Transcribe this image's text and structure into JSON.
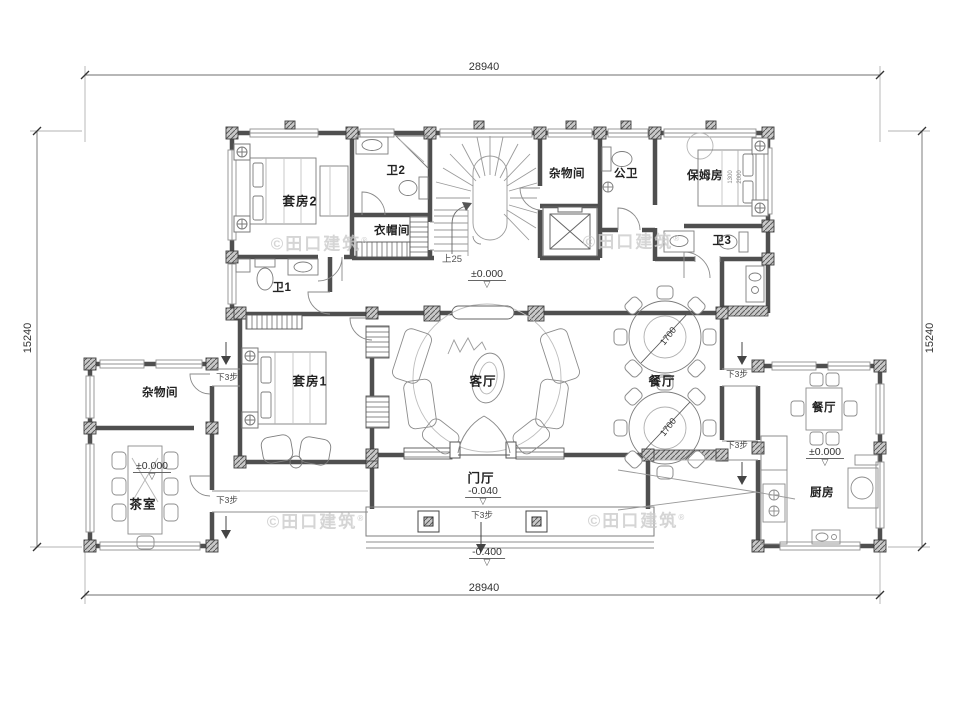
{
  "drawing": {
    "dims": {
      "width": "28940",
      "depth": "15240"
    },
    "rooms": {
      "suite2": "套房2",
      "bath2": "卫2",
      "cloakroom": "衣帽间",
      "storage_top": "杂物间",
      "public_bath": "公卫",
      "nanny_room": "保姆房",
      "bath3": "卫3",
      "bath1": "卫1",
      "suite1": "套房1",
      "living_room": "客厅",
      "dining_room": "餐厅",
      "foyer": "门厅",
      "storage_left": "杂物间",
      "tea_room": "茶室",
      "dining_right": "餐厅",
      "kitchen": "厨房"
    },
    "levels": {
      "main": "±0.000",
      "foyer": "-0.040",
      "porch": "-0.400"
    },
    "annotations": {
      "stair_up": "上25",
      "steps_down3": "下3步",
      "table_diameter": "1700",
      "bed_width": "1300",
      "bed_length": "2000"
    },
    "watermark": {
      "text": "©田口建筑",
      "reg": "®"
    },
    "icons": {
      "level_triangle": "▽"
    },
    "colors": {
      "wall": "#4f4f4f",
      "furniture": "#8c8c8c",
      "text": "#222222",
      "watermark": "#cbcbcb"
    }
  }
}
